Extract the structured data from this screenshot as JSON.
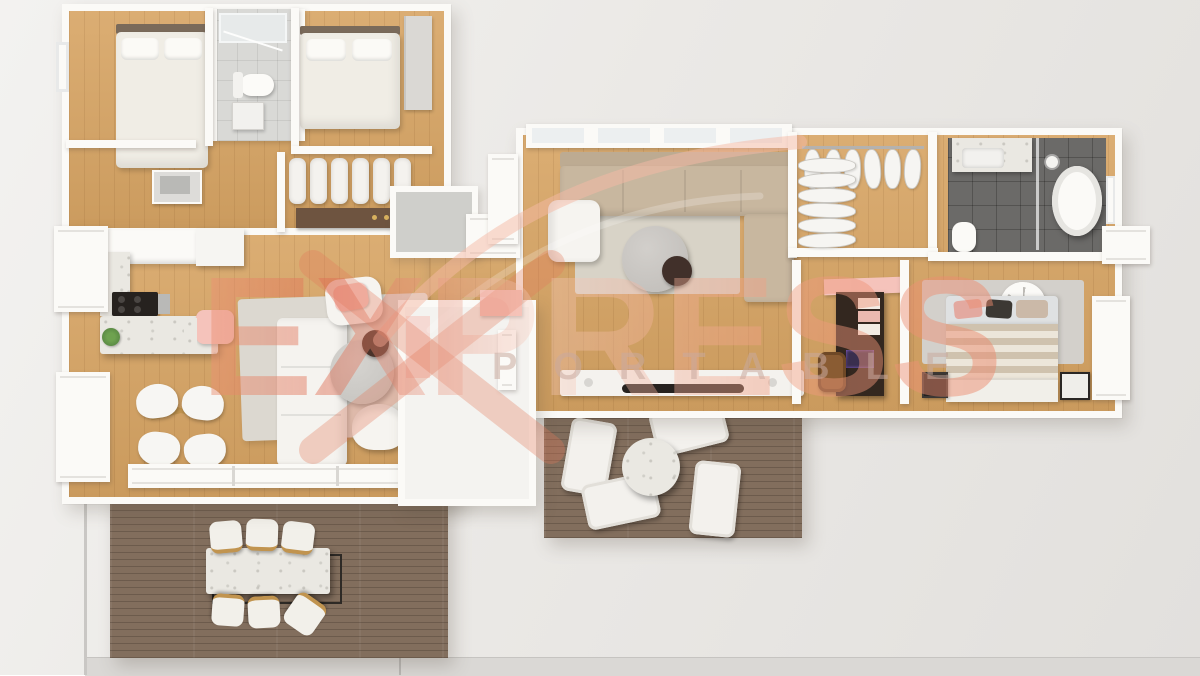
{
  "watermark": {
    "line1": "EXPRESS",
    "line2": "PORTABLE",
    "color_primary": "#ec9476",
    "color_secondary": "#f8cec0"
  },
  "palette": {
    "bg_top": "#f3f2f0",
    "bg_bottom": "#e2e0dd",
    "wall": "#fbfaf7",
    "wood": "#d7a463",
    "deck": "#826e5d",
    "tile_light": "#d9d9d6",
    "tile_dark": "#6b6a68",
    "marble": "#eae8e2",
    "cream": "#f0ede5",
    "beige": "#c8b79f",
    "rug_light": "#dcd8d0",
    "rug_gray": "#d3d0cb",
    "espresso": "#33271f",
    "tan": "#c1944f",
    "pink": "#f5c3bb",
    "salmon": "#eb9678",
    "tv": "#26221f",
    "green": "#5c8c45"
  },
  "scene": {
    "type": "3d-floorplan-top-view-render",
    "rooms": [
      "bedroom-1",
      "bathroom-1",
      "bedroom-2",
      "closet-bench-room",
      "laundry-nook",
      "kitchen",
      "dining-area",
      "living-room-1",
      "utility-white-room",
      "living-room-2",
      "walk-in-closet",
      "bathroom-2",
      "home-office",
      "master-bedroom",
      "lounge-deck",
      "dining-deck"
    ],
    "furniture": [
      "double-bed-1",
      "double-bed-2",
      "master-bed",
      "toilet-1",
      "toilet-2",
      "shower",
      "freestanding-tub",
      "vanity-sink",
      "hanging-clothes",
      "kitchen-island",
      "cooktop",
      "plant",
      "dining-chairs-white",
      "white-sectional-sofa",
      "beige-sectional-sofa",
      "armchair",
      "round-coffee-tables",
      "tv-console",
      "tv",
      "desk-unit",
      "desk-chair",
      "outdoor-dining-table",
      "outdoor-chairs",
      "lounge-chairs",
      "round-side-table",
      "rugs",
      "pink-chaise"
    ]
  }
}
